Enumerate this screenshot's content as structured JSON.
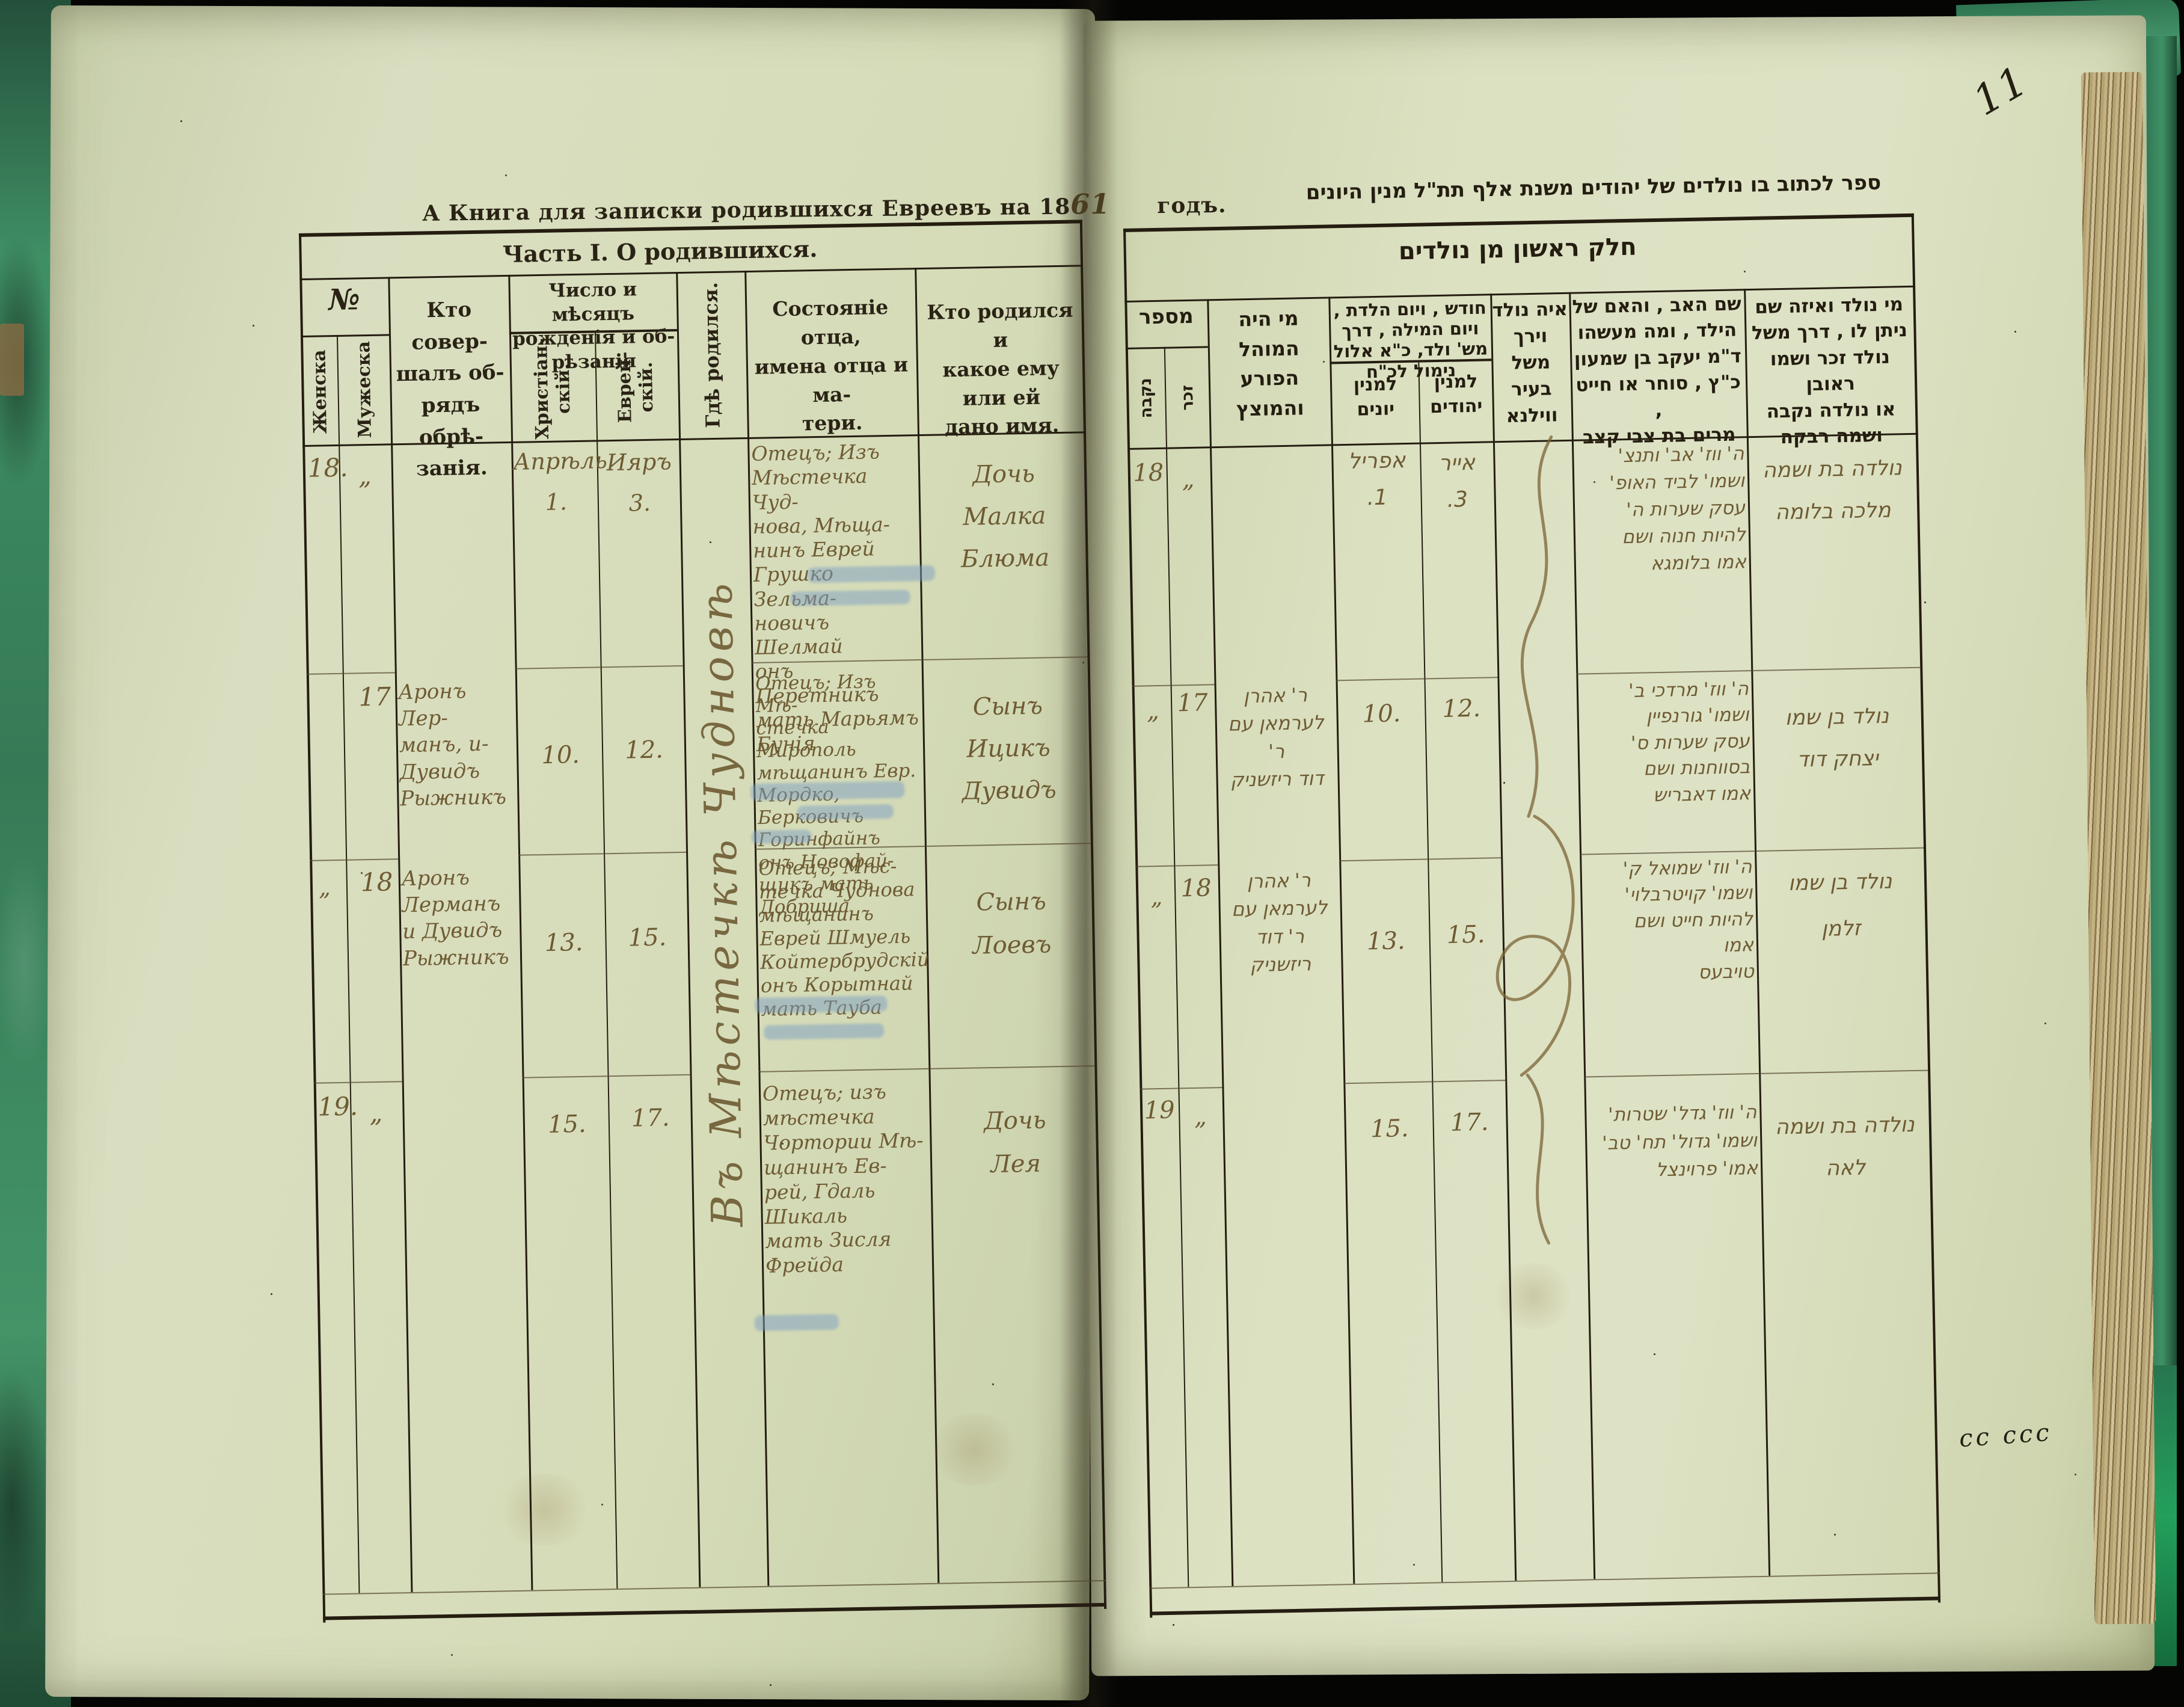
{
  "marginalia": {
    "page_number": "11",
    "bottom_right_scribble": "сс ссс"
  },
  "colors": {
    "paper": "#d7dcba",
    "cloth_green": "#3f9166",
    "print_ink": "#2a2315",
    "handwriting_ink": "#6e5b33",
    "censor_smudge_blue": "#7d9fc4"
  },
  "left_page": {
    "header": {
      "pre": "А Книга для записки родившихся Евреевъ на 18",
      "year": "61",
      "post": "годъ."
    },
    "part_title": "Часть I. О родившихся.",
    "columns": {
      "no": "№",
      "female": "Женска",
      "male": "Мужеска",
      "performer": "Кто совер-\nшалъ об-\nрядъ обрѣ-\nзанія.",
      "dates": "Число и мѣсяцъ\nрожденія и об-\nрѣзанія",
      "christian": "Христіан-\nскій.",
      "jewish": "Еврей-\nскій.",
      "where": "Гдѣ родился.",
      "father": "Состояніе отца,\nимена отца и ма-\nтери.",
      "who": "Кто родился и\nкакое ему или ей\nдано имя."
    },
    "where_note": "Въ Мѣстечкѣ Чудновѣ",
    "rows": [
      {
        "female": "18.",
        "male": "„",
        "performer": "",
        "christian": "Апрѣль\n1.",
        "jewish": "Ияръ\n3.",
        "father": "Отецъ; Изъ\nМѣстечка Чуд-\nнова, Мѣща-\nнинъ Еврей\nГрушко Зельма-\nновичъ Шелмай\nонъ Перетникъ\nмать Марьямъ\nБунія",
        "child": "Дочь\nМалка\nБлюма"
      },
      {
        "female": "",
        "male": "17",
        "performer": "Аронъ Лер-\nманъ, и-\nДувидъ\nРыжникъ",
        "christian": "10.",
        "jewish": "12.",
        "father": "Отецъ; Изъ Мѣ-\nстечка Мирополь\nмѣщанинъ Евр.\nМордко, Берковичъ\nГоринфайнъ\nонъ Новофай-\nщикъ мать\nДобриша",
        "child": "Сынъ\nИцикъ\nДувидъ"
      },
      {
        "female": "„",
        "male": "18",
        "performer": "Аронъ\nЛерманъ\nи Дувидъ\nРыжникъ",
        "christian": "13.",
        "jewish": "15.",
        "father": "Отецъ; Мѣс-\nтечка Чуднова\nмѣщанинъ\nЕврей Шмуель\nКойтербрудскій\nонъ Корытнай\nмать Тауба",
        "child": "Сынъ\nЛоевъ"
      },
      {
        "female": "19.",
        "male": "„",
        "performer": "",
        "christian": "15.",
        "jewish": "17.",
        "father": "Отецъ; изъ\nмѣстечка\nЧортории Мѣ-\nщанинъ Ев-\nрей, Гдаль\nШикаль\nмать Зисля\nФрейда",
        "child": "Дочь\nЛея"
      }
    ]
  },
  "right_page": {
    "header": "ספר לכתוב בו נולדים של יהודים משנת אלף תת\"ל מנין היונים",
    "part_title": "חלק ראשון מן נולדים",
    "columns": {
      "mispar": "מספר",
      "nekeva": "נקבה",
      "zakhar": "זכר",
      "mohel": "מי היה\nהמוהל\nהפורע\nוהמוצץ",
      "dates": "חודש , ויום הלדת ,\nויום המילה , דרך\nמש' ולד, כ\"א אלול\nנימול לכ\"ח",
      "minyan_yevanim": "למנין\nיונים",
      "minyan_yehudim": "למנין\nיהודים",
      "where": "איה נולד\nוירך\nמשל\nבעיר\nווילנא",
      "father": "שם האב , והאם של\nהילד , ומה מעשהו\nד\"מ יעקב בן שמעון\nכ\"ץ , סוחר או חייט ,\nמרים בת צבי קצב",
      "who": "מי נולד ואיזה שם\nניתן לו , דרך משל\nנולד זכר ושמו ראובן\nאו נולדה נקבה\nושמה רבקה"
    },
    "rows": [
      {
        "nekeva": "18",
        "zakhar": "„",
        "mohel": "",
        "yevanim": "אפריל\n1.",
        "yehudim": "אייר\n3.",
        "father": "ה' ווז' אב' ותנצ'\nושמו' לביד האופ'\nעסק שערות ה'\nלהיות חנוה ושם\nאמו בלומגא",
        "child": "נולדה בת ושמה\nמלכה בלומה"
      },
      {
        "nekeva": "„",
        "zakhar": "17",
        "mohel": "ר' אהרן\nלערמאן עם ר'\nדוד ריזשניק",
        "yevanim": "10.",
        "yehudim": "12.",
        "father": "ה' ווז' מרדכי ב'\nושמו' גורנפיין\nעסק שערות ס'\nבסווחנות ושם\nאמו דאבריש",
        "child": "נולד בן שמו\nיצחק דוד"
      },
      {
        "nekeva": "„",
        "zakhar": "18",
        "mohel": "ר' אהרן\nלערמאן עם\nר' דוד\nריזשניק",
        "yevanim": "13.",
        "yehudim": "15.",
        "father": "ה' ווז' שמואל ק'\nושמו' קויטרבלוי'\nלהיות חייט ושם\nאמו\nטויבעס",
        "child": "נולד בן שמו\nזלמן"
      },
      {
        "nekeva": "19",
        "zakhar": "„",
        "mohel": "",
        "yevanim": "15.",
        "yehudim": "17.",
        "father": "ה' ווז' גדל' שטרות'\nושמו' גדול' תח' טב'\nאמו' פרוינצל",
        "child": "נולדה בת ושמה\nלאה"
      }
    ]
  }
}
